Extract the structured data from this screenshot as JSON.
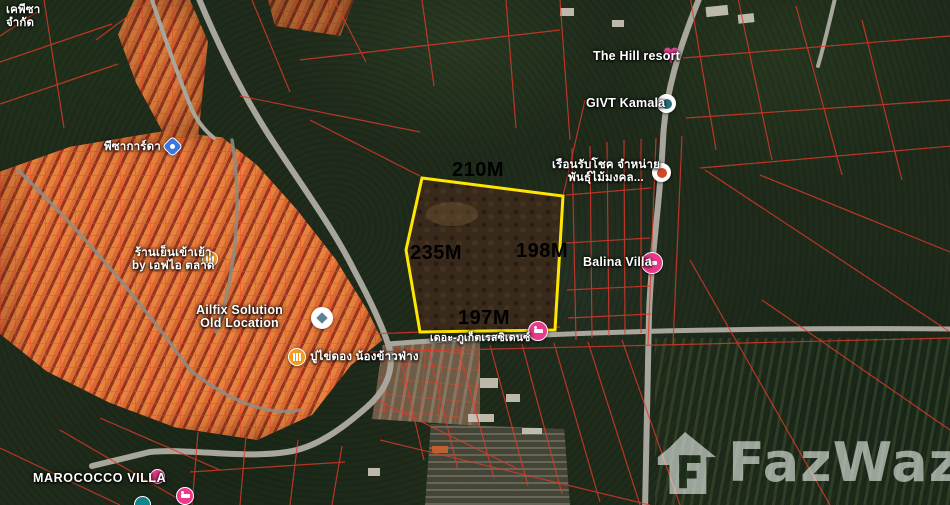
{
  "map": {
    "measurements": {
      "top": "210M",
      "left": "235M",
      "right": "198M",
      "bottom": "197M"
    },
    "labels": {
      "company": {
        "line1": "เคพีซา",
        "line2": "จำกัด"
      },
      "pizagarda": "พีซาการ์ดา",
      "hill_resort": "The Hill resort",
      "givt_kamala": "GIVT Kamala",
      "ruen_rab_chok": {
        "line1": "เรือนรับโชค จำหน่าย",
        "line2": "พันธุ์ไม้มงคล..."
      },
      "balina_villa": "Balina Villa",
      "ailfix": {
        "line1": "Ailfix Solution",
        "line2": "Old Location"
      },
      "noodle_shop": {
        "line1": "ร้านเย็นเข้าเย้า",
        "line2": "by เอฟไอ ตลาด"
      },
      "pu_khai_dong": "ปูไข่ดอง น้องข้าวฟ่าง",
      "phuket_residence": "เดอะ-ภูเก็ตเรสซิเดนซ์",
      "marococco": "MAROCOCCO VILLA"
    },
    "watermark": "FazWaz",
    "icons": {
      "hill_resort_marker": "heart-favorite",
      "givt_marker": "poi-circle",
      "ruen_marker": "shop-circle",
      "balina_marker": "lodging-bed",
      "ailfix_marker": "compass-poi",
      "noodle_marker": "restaurant",
      "pu_khai_dong_marker": "restaurant",
      "phuket_residence_marker": "lodging-bed",
      "marococco_markers": "lodging-cluster",
      "pizagarda_marker": "blue-shield-pin",
      "watermark_icon": "fazwaz-house-logo"
    },
    "colors": {
      "plot_outline": "#ffe600",
      "cadastral_lines": "#e0392b",
      "measurement_text": "#000000",
      "label_text": "#ffffff",
      "marker_pink": "#ea3a8c",
      "marker_orange": "#f59a21",
      "marker_teal": "#12838c",
      "marker_blue": "#3a77e0",
      "road": "#a8a69c"
    }
  }
}
